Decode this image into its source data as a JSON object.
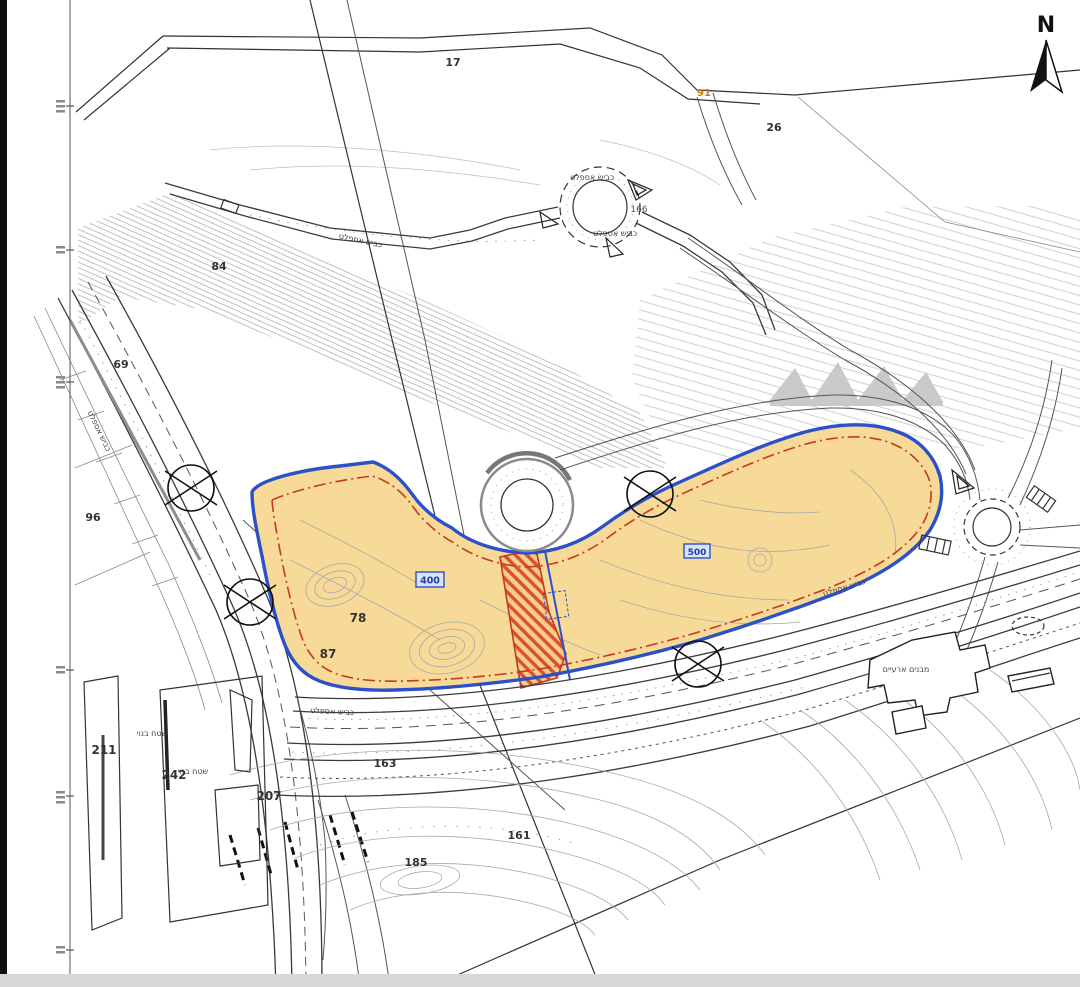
{
  "map": {
    "compass_label": "N",
    "parcels": {
      "p17": "17",
      "p26": "26",
      "p84": "84",
      "p69": "69",
      "p91": "91",
      "p96": "96",
      "p78": "78",
      "p87": "87",
      "p166": "166",
      "p163": "163",
      "p161": "161",
      "p185": "185",
      "p211": "211",
      "p242": "242",
      "p207": "207"
    },
    "plot_tags": {
      "plot_400": "400",
      "plot_500": "500"
    },
    "hebrew": {
      "asphalt_road": "כביש אספלט",
      "temporary_buildings": "מבנים ארעיים",
      "built_area": "שטח בנוי"
    },
    "colors": {
      "highlight_fill": "#f7d998",
      "highlight_outline": "#2b50c8",
      "restriction_line": "#c43a1c",
      "hatch_stripe": "#d9512a",
      "plot_tag_text": "#1b3fae",
      "plot_tag_fill": "#d9e4f6",
      "parcel_91": "#c08012"
    }
  }
}
